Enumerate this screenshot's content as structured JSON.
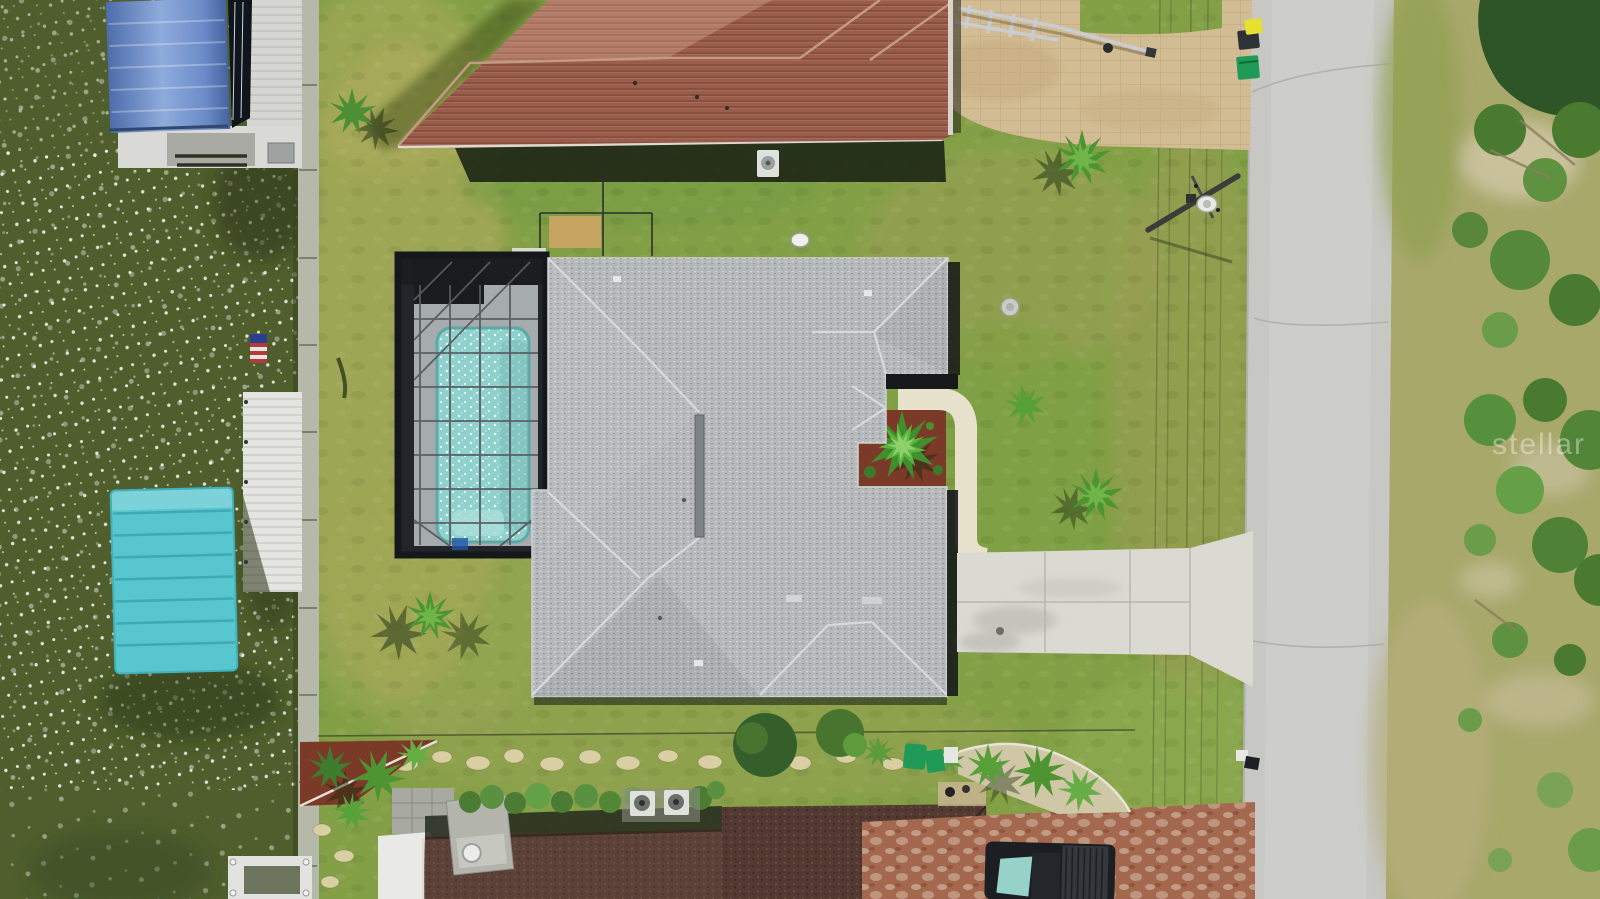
{
  "scene": {
    "description": "Aerial drone photo of a waterfront home with gray hip roof, screened pool enclosure, canal with boat lifts and docks on the left, lawn, concrete driveway and a street with utility lines on the right",
    "watermark": {
      "text": "stellar"
    }
  },
  "palette": {
    "water": "#4f5e2c",
    "lawn": "#84a047",
    "lawn_dry": "#b0ae62",
    "seawall": "#b6b8aa",
    "road": "#c7c7c3",
    "scrub": "#a8a86b",
    "tree_dark": "#2d5527",
    "shrub": "#4a7a30",
    "main_roof": "#b6b9bc",
    "roof_ridge": "#d9dbdd",
    "roof_shadow": "#17191b",
    "top_roof": "#9a5c4b",
    "top_roof_light": "#b5806b",
    "bottom_roof": "#5c4138",
    "bottom_roof_dark": "#4f372f",
    "pool_cage": "#22262a",
    "cage_frame": "#565b60",
    "pool_deck": "#a6abae",
    "pool_water": "#8fd2cd",
    "walkway": "#e8e1cc",
    "driveway": "#dad9d2",
    "pavers_top": "#d2bc93",
    "pavers_red": "#a4684f",
    "mulch": "#7b3a27",
    "canopy_blue_light": "#8fabdc",
    "canopy_blue": "#5e7fc0",
    "canopy_teal": "#58c6ce",
    "dock": "#d6d7d2",
    "dock_roof": "#e4e5e1",
    "boat_hull": "#10141c",
    "truck": "#1b1e22",
    "truck_glass": "#97d2c8",
    "bin_green": "#1f9b57",
    "bin_yellow": "#e6e02f",
    "bin_dark": "#2e3135",
    "flag_red": "#b23a3a",
    "flag_blue": "#2b3f8c",
    "transformer": "#e8eae8",
    "concrete_pad": "#d9dad2",
    "sand": "#cfc7a6",
    "stone": "#d9cfa2",
    "palm": "#4e9433",
    "palm_light": "#6fb54a",
    "ac_unit": "#dfe1dc",
    "trailer": "#c9ccd1",
    "well_cap": "#c9cbc5"
  }
}
